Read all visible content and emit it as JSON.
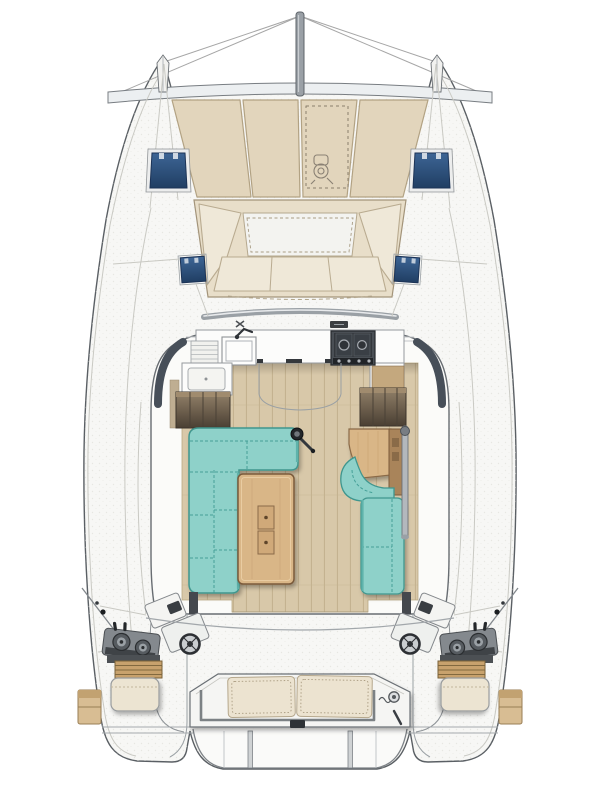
{
  "meta": {
    "title": "Catamaran sailboat deck and saloon floor plan — top-down view, bow at top",
    "figure_type": "boat deck layout diagram",
    "orientation": "bow up, twin hulls, twin aft helm stations",
    "visible_text": "none"
  },
  "palette": {
    "deck": "#f7f7f5",
    "deck_speckle": "#d9d9d3",
    "hull_stroke": "#5a5f64",
    "sunpad": "#e2d5bc",
    "sunpad_border": "#b2a283",
    "cream": "#efe8d8",
    "cream_border": "#b9ab90",
    "navy_hatch": "#3d6595",
    "navy_hatch_deep": "#203e63",
    "teal": "#8ed1c9",
    "teal_edge": "#3f968e",
    "teal_seam": "#3d9a92",
    "teal_shade": "#5fb3ab",
    "wood": "#d9b687",
    "wood_edge": "#7a5a3b",
    "wood_grain": "#c8a271",
    "floor": "#d8c8a9",
    "floor_line": "#c2b08d",
    "counter": "#fcfcfb",
    "counter_edge": "#95999d",
    "stove_dark": "#33373c",
    "stove_frame": "#4a4f55",
    "console": "#84898e",
    "console_edge": "#4a4e52",
    "slat": "#c8a26d",
    "slat_edge": "#7a6239",
    "stair_light": "#93826a",
    "stair_dark": "#4a3f33",
    "windshield": "#474f59",
    "rail": "#9aa0a5",
    "metal": "#2c2f33",
    "cabin": "#fbfbf9"
  },
  "parts": [
    {
      "id": "seagull-striker-pole",
      "label": "Bow pole (seagull striker) with bridle rigging lines"
    },
    {
      "id": "forward-crossbeam",
      "label": "Forward crossbeam between bows"
    },
    {
      "id": "bow-sunpads",
      "label": "Foredeck sunpad cushions",
      "count": 4
    },
    {
      "id": "windlass-hatch",
      "label": "Dashed windlass locker outline with windlass glyph"
    },
    {
      "id": "bow-hatches",
      "label": "Dark-blue bow deck hatches",
      "count": 2
    },
    {
      "id": "forward-cockpit-sofa",
      "label": "Forward cockpit U-shaped lounge seating"
    },
    {
      "id": "coachroof-grabrail",
      "label": "Curved coachroof grab rail"
    },
    {
      "id": "side-deck-hatches",
      "label": "Dark-blue side deck hatches",
      "count": 2
    },
    {
      "id": "galley-counter",
      "label": "Forward galley worktop"
    },
    {
      "id": "galley-sink",
      "label": "Galley sink with mixer tap"
    },
    {
      "id": "galley-prep-sink",
      "label": "Secondary sink / icebox lid"
    },
    {
      "id": "stove",
      "label": "Two-burner stove with control knobs"
    },
    {
      "id": "port-companionway",
      "label": "Companionway steps down to port hull"
    },
    {
      "id": "starboard-companionway",
      "label": "Companionway steps down to starboard hull"
    },
    {
      "id": "door-swings",
      "label": "Saloon door swing arcs"
    },
    {
      "id": "saloon-floor",
      "label": "Wood plank saloon sole"
    },
    {
      "id": "saloon-settee",
      "label": "L-shaped turquoise saloon settee"
    },
    {
      "id": "saloon-table",
      "label": "Rectangular wood saloon table with twin inlays"
    },
    {
      "id": "sheet-winch",
      "label": "Sheet winch with handle"
    },
    {
      "id": "nav-desk",
      "label": "Chart table (starboard)"
    },
    {
      "id": "nav-seat",
      "label": "Curved turquoise navigator seat"
    },
    {
      "id": "starboard-settee",
      "label": "Straight turquoise settee bench"
    },
    {
      "id": "support-post",
      "label": "Saloon support post"
    },
    {
      "id": "helm-stations",
      "label": "Twin aft helm stations with wheel, instrument pod, winches and throttle levers",
      "count": 2
    },
    {
      "id": "helm-seats",
      "label": "Helm seats with teak slat footrests",
      "count": 2
    },
    {
      "id": "quarter-lockers",
      "label": "Tan quarter lockers / boarding steps",
      "count": 2
    },
    {
      "id": "transom-bench",
      "label": "Aft transom bench with two cream cushions"
    },
    {
      "id": "stern-rail",
      "label": "Stern pushpit rail"
    },
    {
      "id": "transom-shower",
      "label": "Transom shower fitting"
    },
    {
      "id": "davits",
      "label": "Davit posts and aft platform"
    },
    {
      "id": "shroud-chainplates",
      "label": "Shroud chainplates with rigging lines",
      "count": 2
    }
  ]
}
